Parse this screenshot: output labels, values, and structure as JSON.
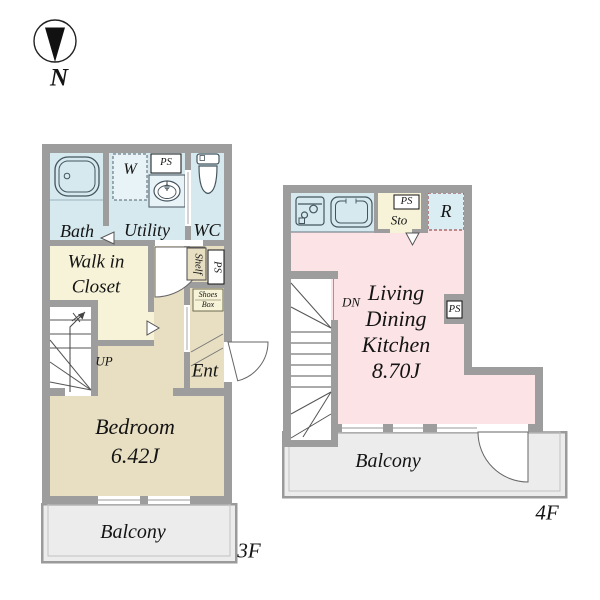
{
  "north": {
    "label": "N"
  },
  "f3": {
    "floor": "3F",
    "bath": "Bath",
    "w": "W",
    "ps_top": "PS",
    "wc": "WC",
    "utility": "Utility",
    "wic1": "Walk in",
    "wic2": "Closet",
    "shelf": "Shelf",
    "ps_side": "PS",
    "shoes1": "Shoes",
    "shoes2": "Box",
    "up": "UP",
    "ent": "Ent",
    "bedroom": "Bedroom",
    "bedroom_size": "6.42J",
    "balcony": "Balcony"
  },
  "f4": {
    "floor": "4F",
    "ps_top": "PS",
    "sto": "Sto",
    "r": "R",
    "dn": "DN",
    "ldk1": "Living",
    "ldk2": "Dining",
    "ldk3": "Kitchen",
    "ldk_size": "8.70J",
    "ps_side": "PS",
    "balcony": "Balcony"
  },
  "colors": {
    "wall_gray": "#9d9d9d",
    "wet_area_blue": "#d5e9ef",
    "floor_tan": "#e8dfc3",
    "closet_yellow": "#f7f3d8",
    "ldk_pink": "#fbe3e6",
    "balcony_gray": "#ececec",
    "fridge_dashed_border": "#9b5353",
    "line_dark": "#444444"
  },
  "icons": {
    "north": "compass-north-arrow",
    "bathtub": "bathtub-icon",
    "washbasin": "washbasin-icon",
    "toilet": "toilet-icon",
    "stove": "stove-icon",
    "kitchen_sink": "kitchen-sink-icon"
  }
}
